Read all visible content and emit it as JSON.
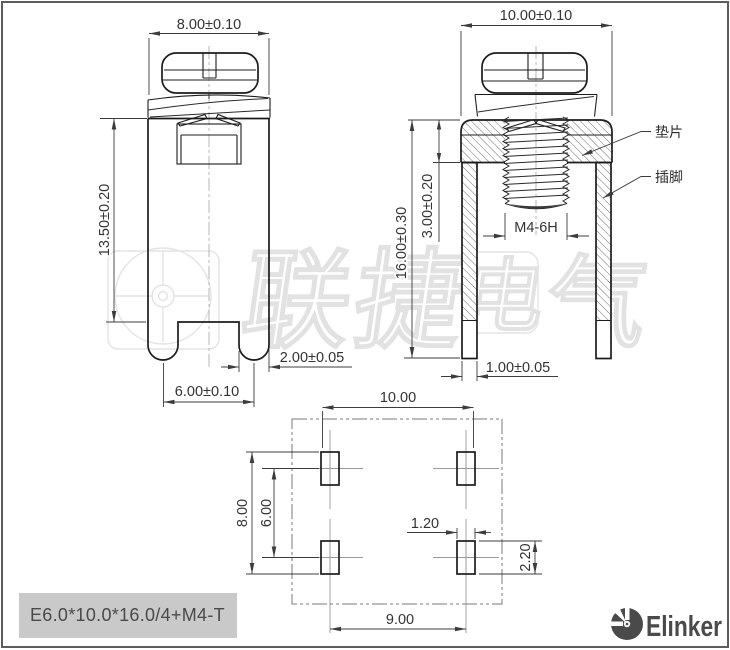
{
  "front_view": {
    "dim_width": "8.00±0.10",
    "dim_body_height": "13.50±0.20",
    "dim_leg_width": "2.00±0.05",
    "dim_leg_pitch": "6.00±0.10"
  },
  "side_view": {
    "dim_width": "10.00±0.10",
    "dim_washer_thickness": "3.00±0.20",
    "dim_total_height": "16.00±0.30",
    "dim_thread": "M4-6H",
    "dim_pin_thickness": "1.00±0.05",
    "label_washer": "垫片",
    "label_pin": "插脚"
  },
  "footprint_view": {
    "dim_outer_width": "10.00",
    "dim_row_outer": "8.00",
    "dim_row_pitch": "6.00",
    "dim_pad_width": "1.20",
    "dim_pad_height": "2.20",
    "dim_col_pitch": "9.00"
  },
  "title_block": {
    "part_number": "E6.0*10.0*16.0/4+M4-T"
  },
  "brand": {
    "logo_text": "Elinker",
    "color": "#4a4a4a"
  },
  "watermark": {
    "full": "联捷电气",
    "char_1": "联",
    "char_2": "捷",
    "char_3": "电",
    "char_4": "气"
  }
}
